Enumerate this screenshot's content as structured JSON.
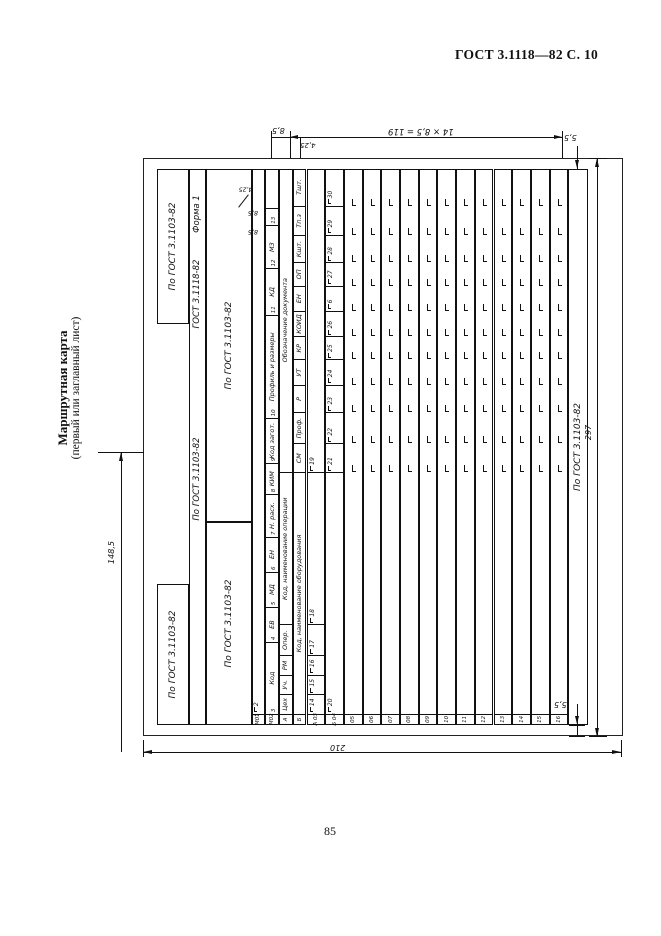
{
  "page": {
    "header": "ГОСТ 3.1118—82 С. 10",
    "number": "85",
    "side_caption_title": "Маршрутная карта",
    "side_caption_subtitle": "(первый или заглавный лист)"
  },
  "form": {
    "caption_gost": "ГОСТ 3.1118-82",
    "caption_form": "Форма 1",
    "gost_box_label": "По ГОСТ 3.1103-82",
    "m01": {
      "label": "М01",
      "num_label_col": "1",
      "num_cell": "2"
    },
    "m02": {
      "label": "М02",
      "cells": [
        {
          "h": "Код",
          "n": "3"
        },
        {
          "h": "ЕВ",
          "n": "4"
        },
        {
          "h": "МД",
          "n": "5"
        },
        {
          "h": "ЕН",
          "n": "6"
        },
        {
          "h": "Н. расх.",
          "n": "7"
        },
        {
          "h": "КИМ",
          "n": "8"
        },
        {
          "h": "Код загот.",
          "n": "9"
        },
        {
          "h": "Профиль и размеры",
          "n": "10"
        },
        {
          "h": "КД",
          "n": "11"
        },
        {
          "h": "МЗ",
          "n": "12"
        },
        {
          "h": "",
          "n": "13"
        }
      ]
    },
    "row_a": {
      "label": "А",
      "cells": [
        "Цех",
        "Уч.",
        "РМ",
        "Опер.",
        "Код, наименование операции",
        "Обозначение документа"
      ]
    },
    "row_b": {
      "label": "Б",
      "cells": [
        "Код, наименование оборудования",
        "СМ",
        "Проф.",
        "Р",
        "УТ",
        "КР",
        "КОИД",
        "ЕН",
        "ОП",
        "Кшт.",
        "Тп.з",
        "Тшт."
      ]
    },
    "row_a03": {
      "label": "А 03",
      "nums": [
        "14",
        "15",
        "16",
        "17",
        "18",
        "19"
      ]
    },
    "row_b04": {
      "label": "Б 04",
      "nums": [
        "20",
        "21",
        "22",
        "23",
        "24",
        "25",
        "26",
        "6",
        "27",
        "28",
        "29",
        "30"
      ]
    },
    "empty_rows": [
      "05",
      "06",
      "07",
      "08",
      "09",
      "10",
      "11",
      "12",
      "13",
      "14",
      "15",
      "16"
    ],
    "footer_box": "По ГОСТ 3.1103-82"
  },
  "dimensions": {
    "half_width": "148,5",
    "width": "210",
    "height": "297",
    "margin_top": "5,5",
    "margin_bottom": "5,5",
    "row_height": "8,5",
    "half_row": "4,25",
    "rows_block": "14 × 8,5 = 119",
    "cell13_dim1": "8,5",
    "cell13_dim2": "8,5",
    "cell13_dim3": "4,25"
  }
}
